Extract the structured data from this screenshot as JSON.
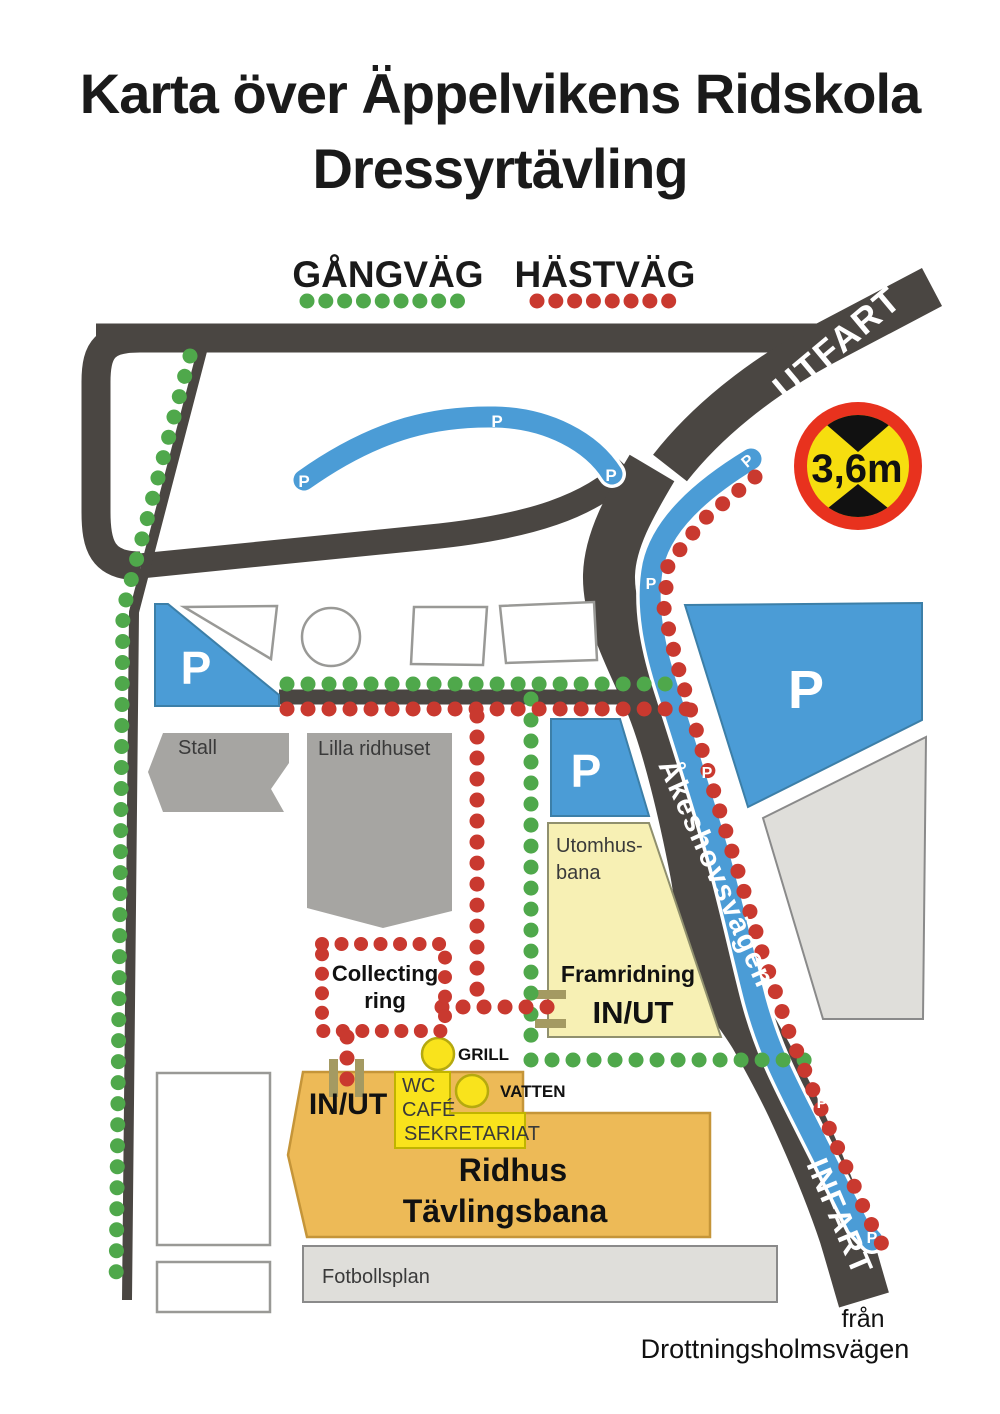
{
  "title": {
    "line1": "Karta över Äppelvikens Ridskola",
    "line2": "Dressyrtävling"
  },
  "legend": {
    "walk_label": "GÅNGVÄG",
    "horse_label": "HÄSTVÄG"
  },
  "roads": {
    "utfart": "UTFART",
    "infart": "INFART",
    "main_street": "Åkeshovsvägen",
    "from_line1": "från",
    "from_line2": "Drottningsholmsvägen"
  },
  "sign": {
    "limit": "3,6m"
  },
  "areas": {
    "stall": "Stall",
    "lilla_ridhuset": "Lilla ridhuset",
    "utomhus_line1": "Utomhus-",
    "utomhus_line2": "bana",
    "framridning": "Framridning",
    "framridning_gate": "IN/UT",
    "collecting_line1": "Collecting",
    "collecting_line2": "ring",
    "grill": "GRILL",
    "vatten": "VATTEN",
    "wc": "WC",
    "cafe": "CAFÉ",
    "sekretariat": "SEKRETARIAT",
    "ridhus_gate": "IN/UT",
    "ridhus_line1": "Ridhus",
    "ridhus_line2": "Tävlingsbana",
    "fotbollsplan": "Fotbollsplan"
  },
  "parking_letter": "P",
  "colors": {
    "walk": "#4fa84b",
    "horse": "#c9392f",
    "road": "#4a4642",
    "parking_blue": "#4b9cd6",
    "building_gray": "#a6a5a2",
    "area_light": "#dfdeda",
    "yellow_pale": "#f7f0b4",
    "yellow_bright": "#f9e31c",
    "orange": "#edba57",
    "gate": "#a49a62",
    "sign_red": "#e8321e",
    "sign_yellow": "#f6de0f"
  }
}
